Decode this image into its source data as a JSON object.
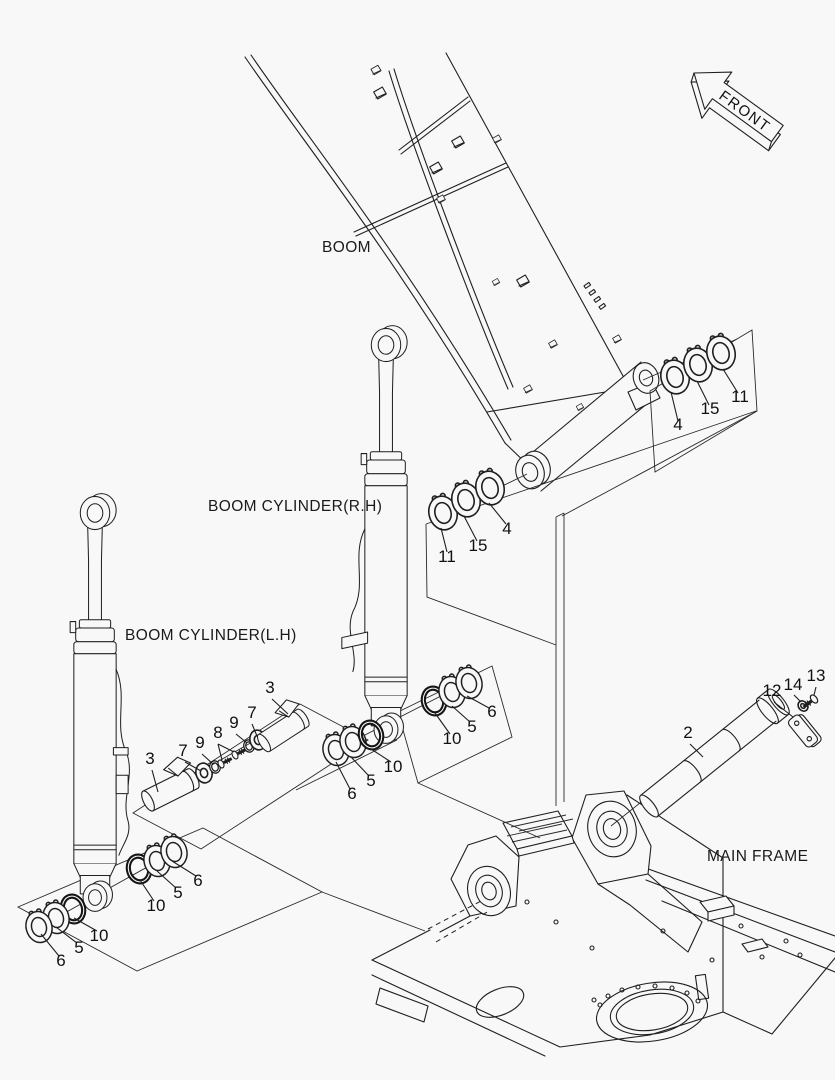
{
  "page": {
    "background": "#f8f8f8",
    "line_color": "#1f1f1f",
    "type": "exploded parts diagram"
  },
  "labels": {
    "front": "FRONT",
    "boom": "BOOM",
    "boom_cylinder_rh": "BOOM CYLINDER(R.H)",
    "boom_cylinder_lh": "BOOM CYLINDER(L.H)",
    "main_frame": "MAIN FRAME"
  },
  "part_numbers": {
    "n2": "2",
    "n3": "3",
    "n4": "4",
    "n5": "5",
    "n6": "6",
    "n7": "7",
    "n8": "8",
    "n9": "9",
    "n10": "10",
    "n11": "11",
    "n12": "12",
    "n13": "13",
    "n14": "14",
    "n15": "15"
  },
  "callouts": [
    {
      "part": "4",
      "group": "boom-foot-right-rings"
    },
    {
      "part": "15",
      "group": "boom-foot-right-rings"
    },
    {
      "part": "11",
      "group": "boom-foot-right-rings"
    },
    {
      "part": "11",
      "group": "boom-foot-left-rings"
    },
    {
      "part": "15",
      "group": "boom-foot-left-rings"
    },
    {
      "part": "4",
      "group": "boom-foot-left-rings"
    },
    {
      "part": "10",
      "group": "rh-cylinder-foot-right-rings"
    },
    {
      "part": "5",
      "group": "rh-cylinder-foot-right-rings"
    },
    {
      "part": "6",
      "group": "rh-cylinder-foot-right-rings"
    },
    {
      "part": "10",
      "group": "rh-cylinder-foot-left-rings"
    },
    {
      "part": "5",
      "group": "rh-cylinder-foot-left-rings"
    },
    {
      "part": "6",
      "group": "rh-cylinder-foot-left-rings"
    },
    {
      "part": "10",
      "group": "lh-cylinder-foot-right-rings"
    },
    {
      "part": "5",
      "group": "lh-cylinder-foot-right-rings"
    },
    {
      "part": "6",
      "group": "lh-cylinder-foot-right-rings"
    },
    {
      "part": "10",
      "group": "lh-cylinder-foot-left-rings"
    },
    {
      "part": "5",
      "group": "lh-cylinder-foot-left-rings"
    },
    {
      "part": "6",
      "group": "lh-cylinder-foot-left-rings"
    },
    {
      "part": "3",
      "group": "cylinder-pin-upper"
    },
    {
      "part": "7",
      "group": "cylinder-pin-hardware"
    },
    {
      "part": "9",
      "group": "cylinder-pin-hardware"
    },
    {
      "part": "8",
      "group": "cylinder-pin-hardware"
    },
    {
      "part": "9",
      "group": "cylinder-pin-hardware"
    },
    {
      "part": "7",
      "group": "cylinder-pin-hardware"
    },
    {
      "part": "3",
      "group": "cylinder-pin-lower"
    },
    {
      "part": "2",
      "group": "boom-foot-pin"
    },
    {
      "part": "12",
      "group": "boom-foot-pin-lock"
    },
    {
      "part": "14",
      "group": "boom-foot-pin-lock"
    },
    {
      "part": "13",
      "group": "boom-foot-pin-lock"
    }
  ]
}
